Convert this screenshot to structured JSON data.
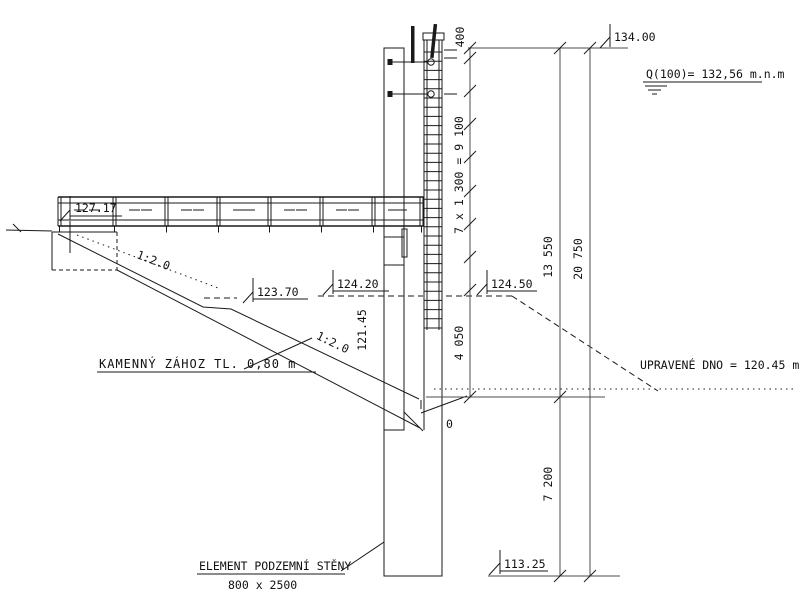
{
  "drawing": {
    "background": "#ffffff",
    "line_color": "#1a1a1a",
    "dim_line_color": "#4d4d4d",
    "notes": {
      "q100": "Q(100)= 132,56 m.n.m",
      "upravene_dno": "UPRAVENÉ DNO = 120.45 m",
      "kamenny_zahoz": "KAMENNÝ ZÁHOZ TL. 0,80 m",
      "element_title": "ELEMENT PODZEMNÍ STĚNY",
      "element_size": "800 x 2500"
    },
    "elevations": {
      "top": "134.00",
      "deck": "127.17",
      "left_water": "124.20",
      "right_ground": "124.50",
      "berm": "123.70",
      "riprap_toe": "121.45",
      "wall_bottom": "113.25"
    },
    "slopes": {
      "upper": "1:2.0",
      "lower": "1:2.0"
    },
    "dimensions": {
      "d400": "400",
      "d9100": "7 x 1 300 = 9 100",
      "d4050": "4 050",
      "d13550": "13 550",
      "d20750": "20 750",
      "d7200": "7 200",
      "toe_zero": "0"
    }
  }
}
